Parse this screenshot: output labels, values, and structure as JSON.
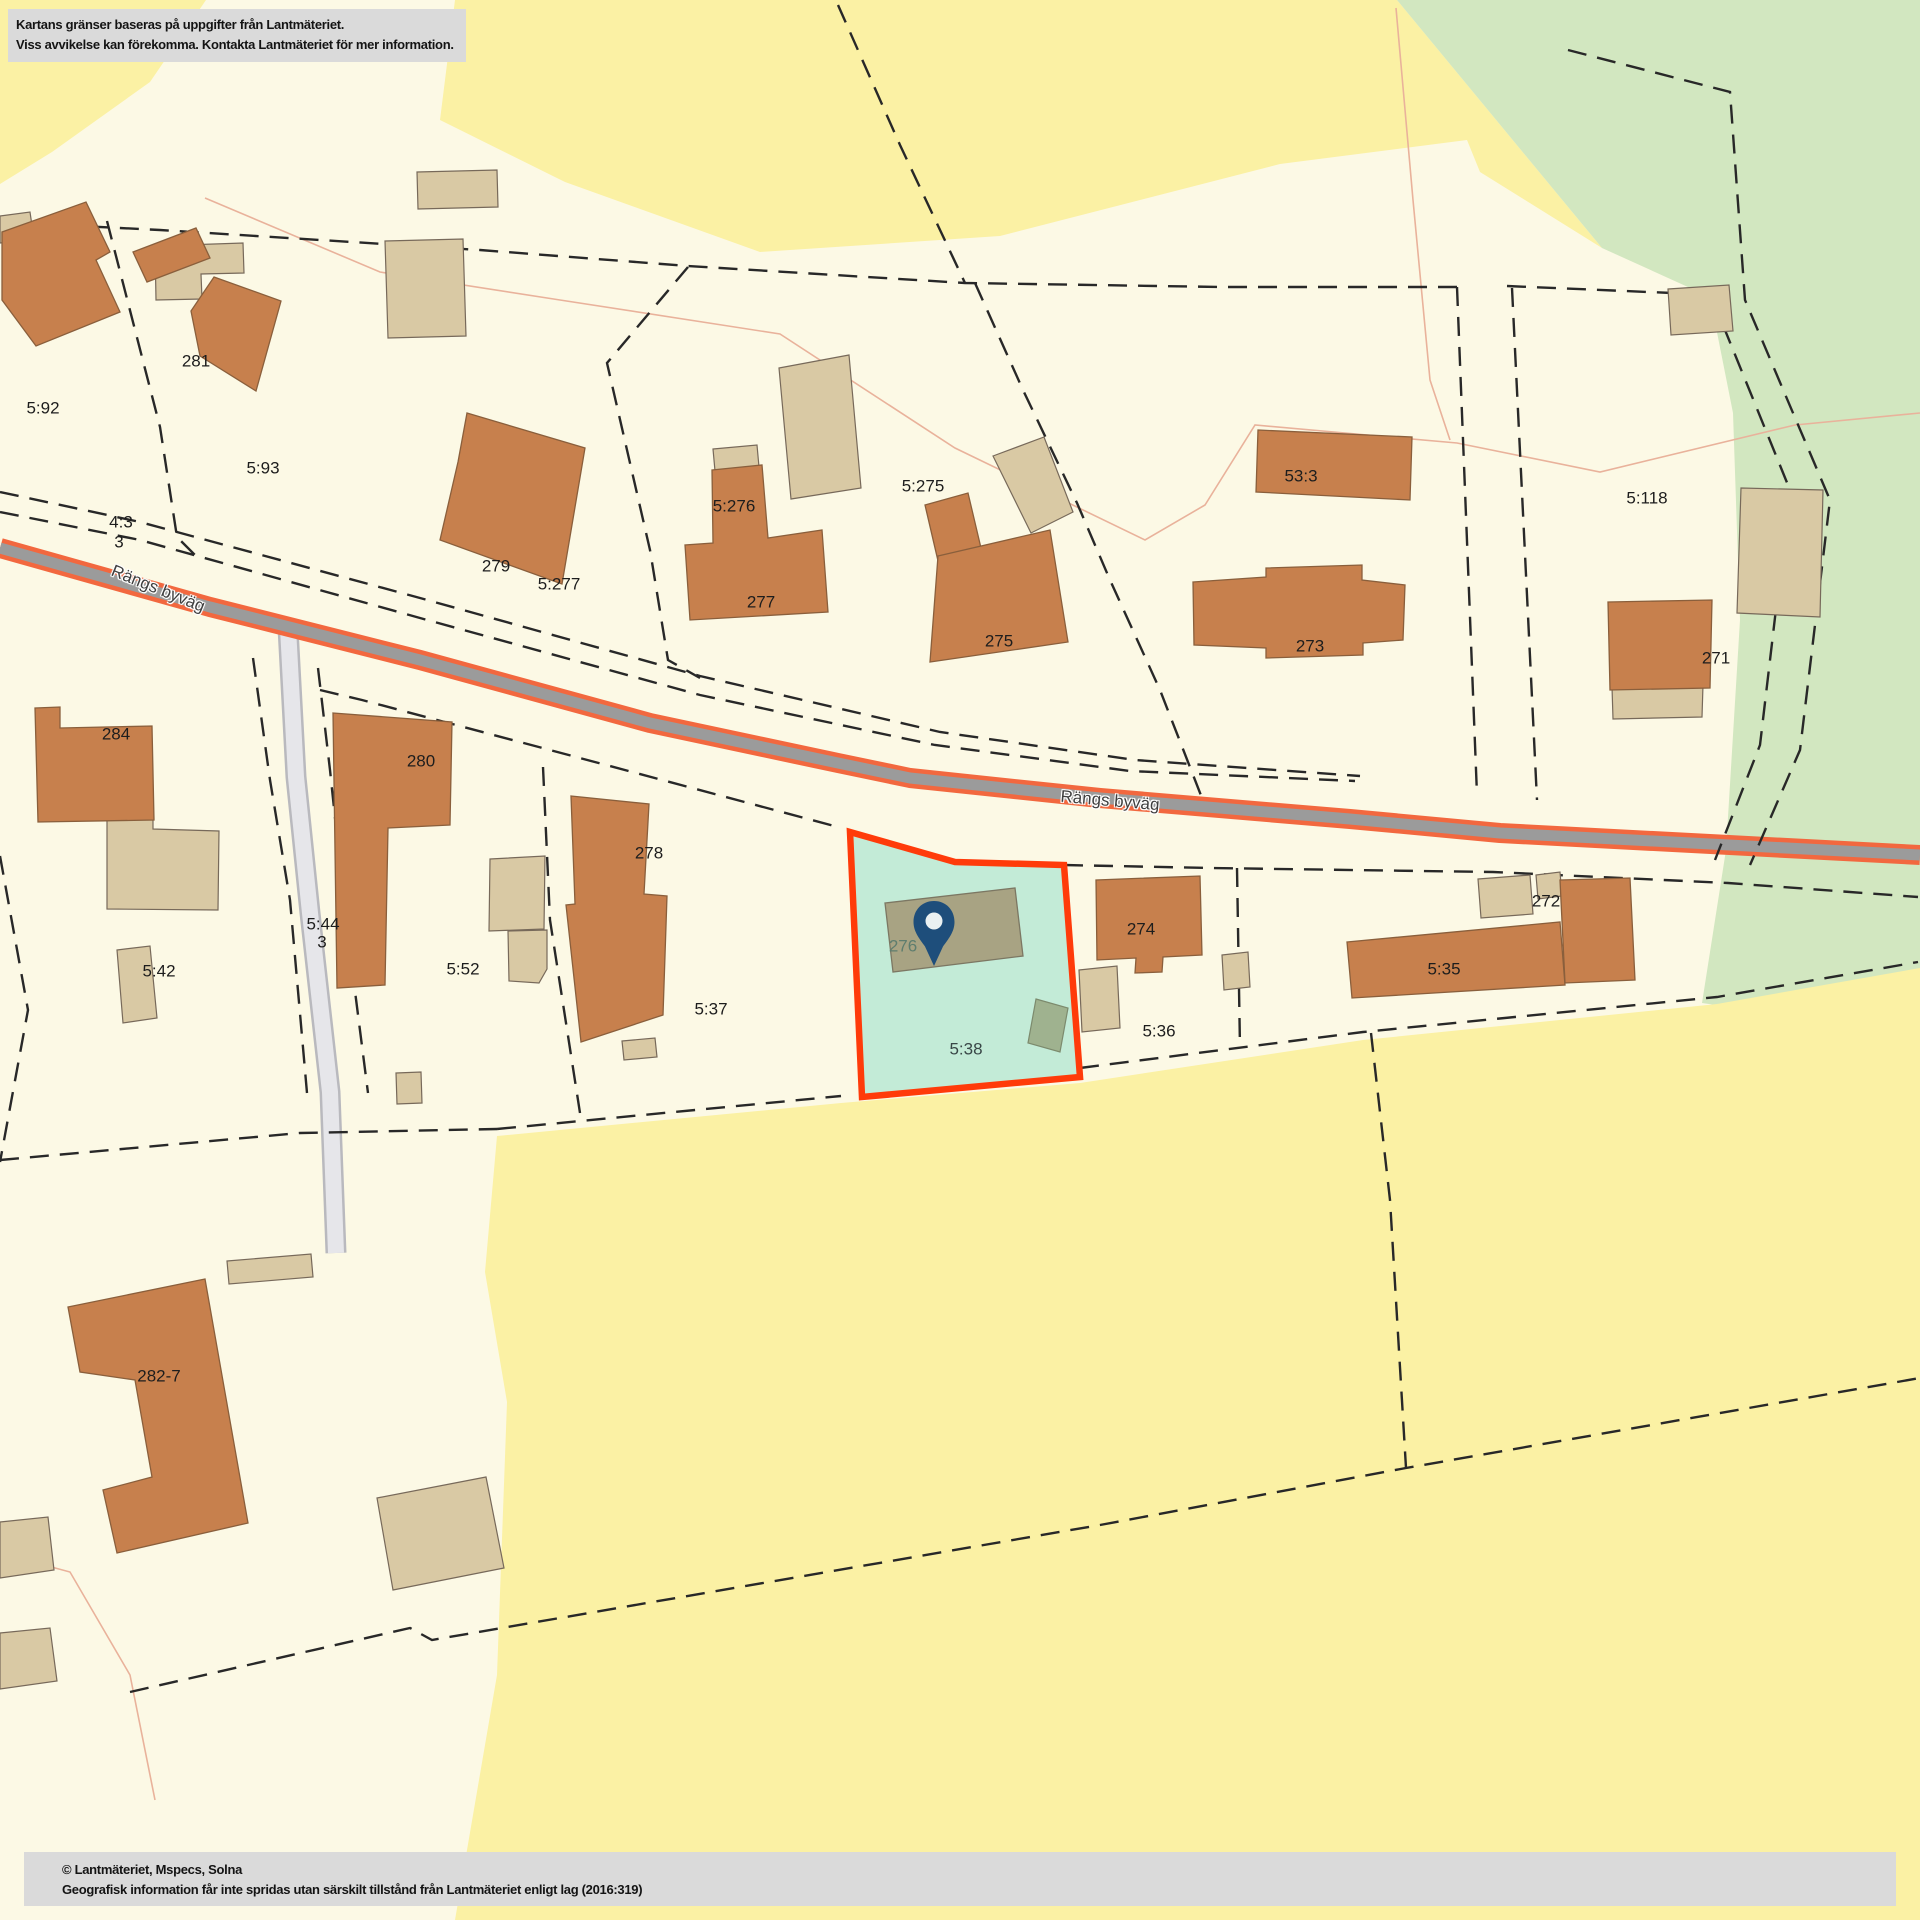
{
  "disclaimer": {
    "line1": "Kartans gränser baseras på uppgifter från Lantmäteriet.",
    "line2": "Viss avvikelse kan förekomma. Kontakta Lantmäteriet för mer information."
  },
  "attribution": {
    "line1": "© Lantmäteriet, Mspecs, Solna",
    "line2": "Geografisk information får inte spridas utan särskilt tillstånd från Lantmäteriet enligt lag (2016:319)"
  },
  "road_labels": [
    {
      "text": "Rängs byväg"
    },
    {
      "text": "Rängs byväg"
    }
  ],
  "parcel_labels": [
    {
      "text": "5:92"
    },
    {
      "text": "281"
    },
    {
      "text": "5:93"
    },
    {
      "text": "4:3"
    },
    {
      "text": "3"
    },
    {
      "text": "279"
    },
    {
      "text": "5:277"
    },
    {
      "text": "5:276"
    },
    {
      "text": "277"
    },
    {
      "text": "5:275"
    },
    {
      "text": "275"
    },
    {
      "text": "53:3"
    },
    {
      "text": "273"
    },
    {
      "text": "5:118"
    },
    {
      "text": "271"
    },
    {
      "text": "284"
    },
    {
      "text": "280"
    },
    {
      "text": "5:44"
    },
    {
      "text": "3"
    },
    {
      "text": "5:42"
    },
    {
      "text": "5:52"
    },
    {
      "text": "278"
    },
    {
      "text": "5:37"
    },
    {
      "text": "274"
    },
    {
      "text": "5:36"
    },
    {
      "text": "272"
    },
    {
      "text": "5:35"
    },
    {
      "text": "282-7"
    }
  ],
  "highlight": {
    "building_label": "276",
    "parcel_label": "5:38"
  },
  "icons": {
    "pin": "location-pin"
  },
  "colors": {
    "parcel_cream": "#FCF9E5",
    "field_yellow": "#FBF1A4",
    "forest_green": "#D2E7C0",
    "road_edge": "#F2683F",
    "road_fill": "#9B9B9B",
    "minor_road": "#E6E6EA",
    "boundary_dash": "#282828",
    "house_orange": "#C7804D",
    "outbuilding_beige": "#D9C9A4",
    "highlight_fill": "#C3EBD7",
    "highlight_border": "#FF3B0A",
    "pin_blue": "#1E4E7B",
    "notice_gray": "#DADADA"
  }
}
